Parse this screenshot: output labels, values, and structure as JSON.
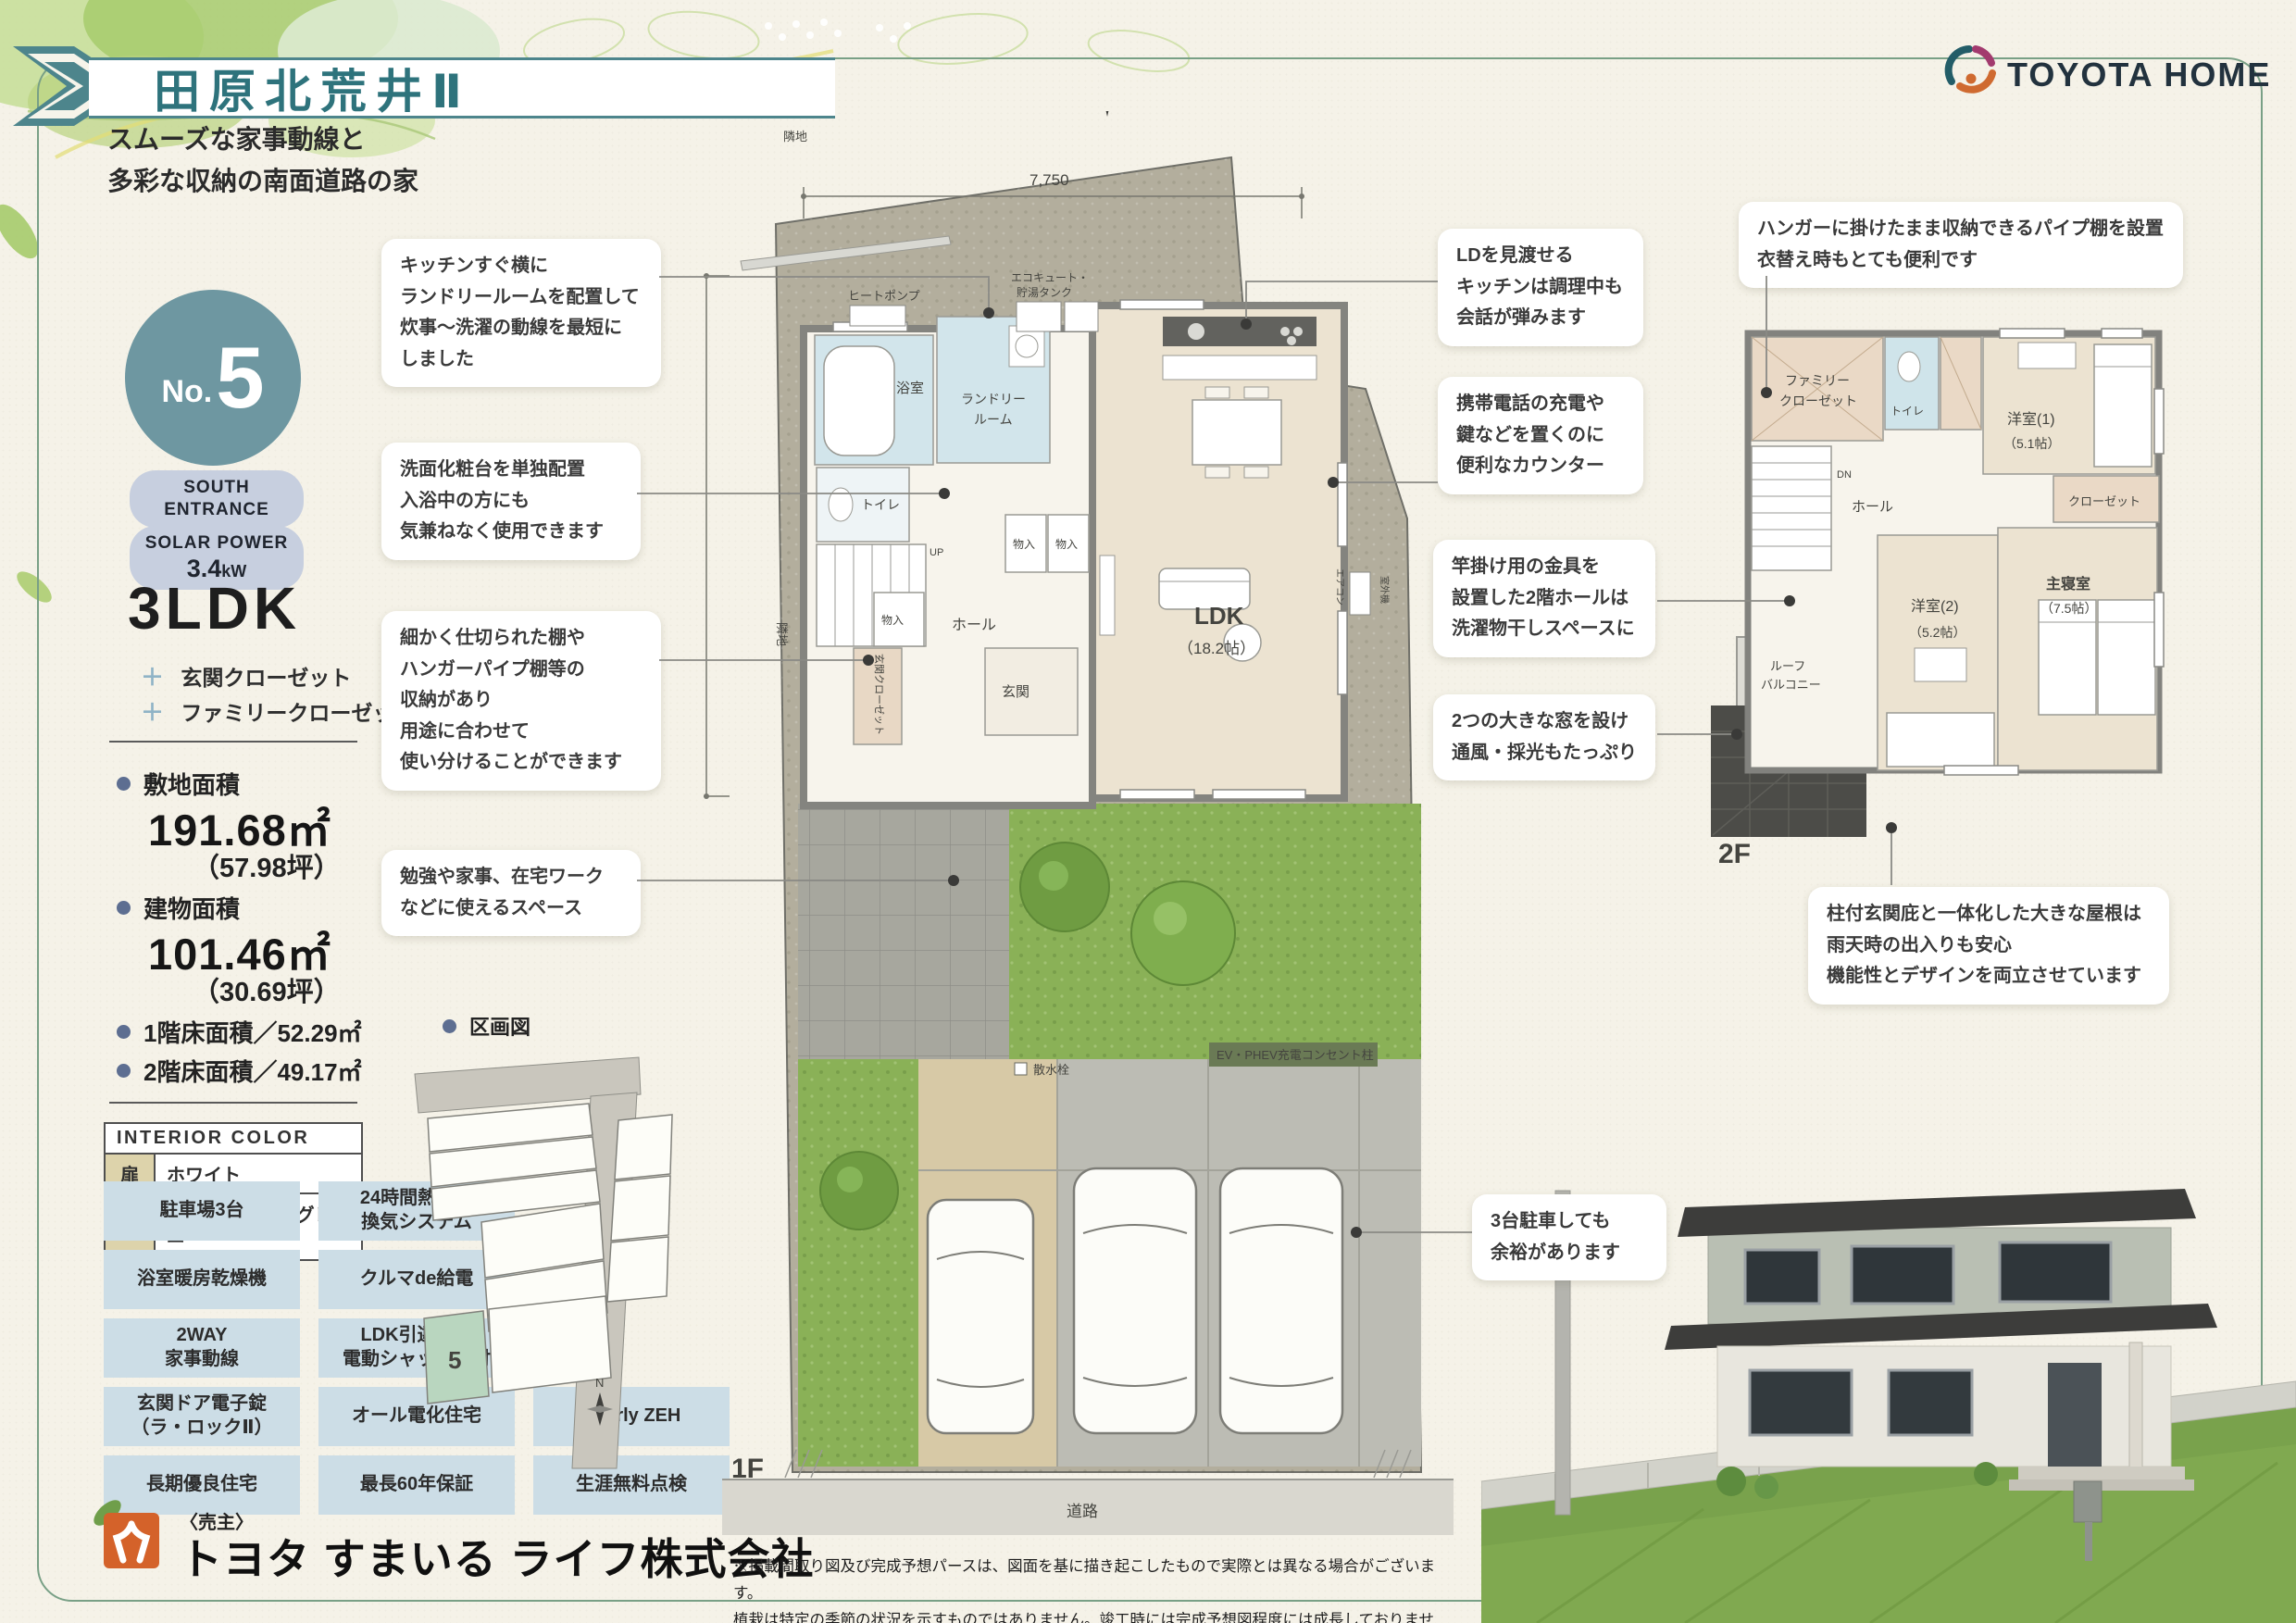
{
  "page": {
    "title": "田原北荒井Ⅱ",
    "subtitle1": "スムーズな家事動線と",
    "subtitle2": "多彩な収納の南面道路の家"
  },
  "brand": {
    "name": "TOYOTA HOME"
  },
  "unit": {
    "no_prefix": "No.",
    "no": "5",
    "badge_entrance1": "SOUTH",
    "badge_entrance2": "ENTRANCE",
    "badge_solar_label": "SOLAR POWER",
    "badge_solar_value": "3.4",
    "badge_solar_unit": "kW",
    "plan_type": "3LDK",
    "extras": [
      {
        "mark": "＋",
        "label": "玄関クローゼット"
      },
      {
        "mark": "＋",
        "label": "ファミリークローゼット"
      }
    ],
    "site_area_label": "敷地面積",
    "site_area_value": "191.68㎡",
    "site_area_tsubo": "（57.98坪）",
    "bldg_area_label": "建物面積",
    "bldg_area_value": "101.46㎡",
    "bldg_area_tsubo": "（30.69坪）",
    "floor1_area": "1階床面積／52.29㎡",
    "floor2_area": "2階床面積／49.17㎡"
  },
  "interior_color": {
    "header": "INTERIOR COLOR",
    "rows": [
      {
        "label": "扉",
        "value": "ホワイト"
      },
      {
        "label": "床",
        "value": "オーク柄ペールグレー"
      }
    ]
  },
  "features": [
    {
      "label": "駐車場3台"
    },
    {
      "label": "24時間熱交換\n換気システム"
    },
    {
      "label": "浴室暖房乾燥機"
    },
    {
      "label": "クルマde給電"
    },
    {
      "label": "2WAY\n家事動線"
    },
    {
      "label": "LDK引違い窓\n電動シャッター付"
    },
    {
      "label": "玄関ドア電子錠\n（ラ・ロックⅡ）"
    },
    {
      "label": "オール電化住宅"
    },
    {
      "label": "Nearly ZEH"
    },
    {
      "label": "長期優良住宅"
    },
    {
      "label": "最長60年保証"
    },
    {
      "label": "生涯無料点検"
    }
  ],
  "lot_map": {
    "title": "区画図",
    "lot_no": "5",
    "compass": "N"
  },
  "callouts": {
    "kitchen_laundry": {
      "lines": [
        "キッチンすぐ横に",
        "ランドリールームを配置して",
        "炊事～洗濯の動線を最短に",
        "しました"
      ]
    },
    "vanity": {
      "lines": [
        "洗面化粧台を単独配置",
        "入浴中の方にも",
        "気兼ねなく使用できます"
      ]
    },
    "shelf": {
      "lines": [
        "細かく仕切られた棚や",
        "ハンガーパイプ棚等の",
        "収納があり",
        "用途に合わせて",
        "使い分けることができます"
      ]
    },
    "workspace": {
      "lines": [
        "勉強や家事、在宅ワーク",
        "などに使えるスペース"
      ]
    },
    "ld_kitchen": {
      "lines": [
        "LDを見渡せる",
        "キッチンは調理中も",
        "会話が弾みます"
      ]
    },
    "counter": {
      "lines": [
        "携帯電話の充電や",
        "鍵などを置くのに",
        "便利なカウンター"
      ]
    },
    "hall2f": {
      "lines": [
        "竿掛け用の金具を",
        "設置した2階ホールは",
        "洗濯物干しスペースに"
      ]
    },
    "windows": {
      "lines": [
        "2つの大きな窓を設け",
        "通風・採光もたっぷり"
      ]
    },
    "pipe_shelf": {
      "lines": [
        "ハンガーに掛けたまま収納できるパイプ棚を設置",
        "衣替え時もとても便利です"
      ]
    },
    "roof": {
      "lines": [
        "柱付玄関庇と一体化した大きな屋根は",
        "雨天時の出入りも安心",
        "機能性とデザインを両立させています"
      ]
    },
    "parking": {
      "lines": [
        "3台駐車しても",
        "余裕があります"
      ]
    }
  },
  "plan1f": {
    "floor_label": "1F",
    "dim_width": "7,750",
    "dim_depth": "7,500",
    "neighbor": "隣地",
    "road": "道路",
    "compass_n": "N",
    "rooms": {
      "bath": "浴室",
      "laundry1": "ランドリー",
      "laundry2": "ルーム",
      "toilet": "トイレ",
      "hall": "ホール",
      "storage": "物入",
      "entrance": "玄関",
      "entrance_closet": "玄関クローゼット",
      "ldk": "LDK",
      "ldk_size": "（18.2帖）",
      "up": "UP"
    },
    "equip": {
      "heat_pump": "ヒートポンプ",
      "ecocute1": "エコキュート・",
      "ecocute2": "貯湯タンク",
      "outdoor_unit": "室外機",
      "aircon": "エアコン",
      "ev_outlet": "EV・PHEV充電コンセント柱",
      "sprinkler": "散水栓"
    }
  },
  "plan2f": {
    "floor_label": "2F",
    "rooms": {
      "family_closet1": "ファミリー",
      "family_closet2": "クローゼット",
      "toilet": "トイレ",
      "west1": "洋室(1)",
      "west1_size": "（5.1帖）",
      "closet": "クローゼット",
      "hall": "ホール",
      "dn": "DN",
      "west2": "洋室(2)",
      "west2_size": "（5.2帖）",
      "master": "主寝室",
      "master_size": "（7.5帖）",
      "balcony1": "ルーフ",
      "balcony2": "バルコニー"
    }
  },
  "footer": {
    "seller": "〈売主〉",
    "company": "トヨタ すまいる ライフ株式会社",
    "disclaimer1": "※掲載間取り図及び完成予想パースは、図面を基に描き起こしたもので実際とは異なる場合がございます。",
    "disclaimer2": "植栽は特定の季節の状況を示すものではありません。竣工時には完成予想図程度には成長しておりません。あらかじめご了承ください。"
  },
  "colors": {
    "accent_teal": "#2e737c",
    "circle_teal": "#6e97a1",
    "badge_bg": "#c7cfdf",
    "feature_bg": "#ccdde6",
    "khaki_cell": "#ddd3ab",
    "lot_green": "#b9d6bf",
    "grass": "#8ab157",
    "ground": "#b3ae9d"
  }
}
